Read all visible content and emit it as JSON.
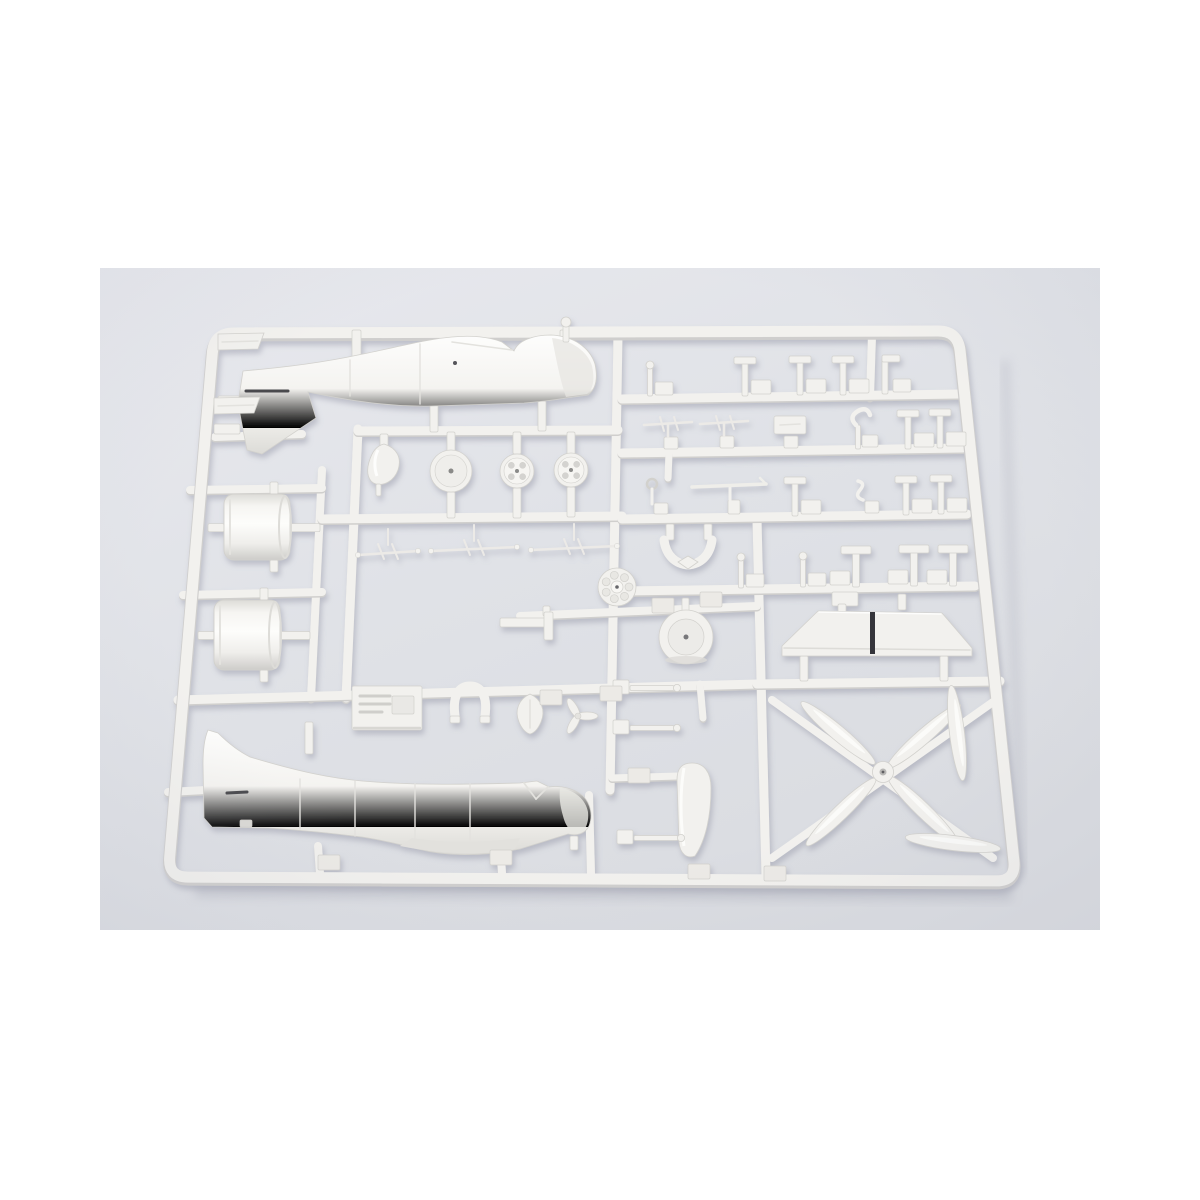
{
  "meta": {
    "description": "Product photograph of a white plastic injection-molded model kit sprue (parts tree) for an aircraft model, lying on a pale gray surface. The runner frame holds two fuselage halves, two engine cowlings, wheels, a spinner cone, a cowl ring, a wing center section, propeller blades and many small brackets and struts."
  },
  "canvas": {
    "width": 1200,
    "height": 1200,
    "page_bg": "#ffffff"
  },
  "photo": {
    "x": 100,
    "y": 268,
    "width": 1000,
    "height": 662,
    "bg_top": "#e8e9ee",
    "bg_mid": "#e0e2e7",
    "bg_bottom": "#dadce1",
    "vignette": "#b7bac6"
  },
  "colors": {
    "plastic": "#f2f1ee",
    "plastic_bright": "#fbfbf9",
    "plastic_shade": "#d7d6d3",
    "plastic_deep": "#c6c5c3",
    "edge": "#d2d1cd",
    "gate": "#eceae6",
    "detail_line": "#e3e2de",
    "slot_dark": "#35353a",
    "hole": "#8a8a88",
    "shadow": "#8d8fa0",
    "soft_shadow": "#b6b8c2"
  },
  "frame": {
    "corners": [
      [
        214,
        333
      ],
      [
        958,
        331
      ],
      [
        1016,
        881
      ],
      [
        168,
        877
      ]
    ],
    "radius": 20,
    "width": 11
  },
  "rails": [
    {
      "x1": 358,
      "y1": 429,
      "x2": 346,
      "y2": 698,
      "w": 9
    },
    {
      "x1": 322,
      "y1": 470,
      "x2": 311,
      "y2": 698,
      "w": 8
    },
    {
      "x1": 618,
      "y1": 335,
      "x2": 610,
      "y2": 790,
      "w": 9
    },
    {
      "x1": 757,
      "y1": 521,
      "x2": 766,
      "y2": 876,
      "w": 9
    },
    {
      "x1": 872,
      "y1": 335,
      "x2": 870,
      "y2": 397,
      "w": 8
    },
    {
      "x1": 358,
      "y1": 431,
      "x2": 618,
      "y2": 430,
      "w": 9
    },
    {
      "x1": 215,
      "y1": 437,
      "x2": 302,
      "y2": 434,
      "w": 8
    },
    {
      "x1": 322,
      "y1": 519,
      "x2": 622,
      "y2": 516,
      "w": 9
    },
    {
      "x1": 190,
      "y1": 490,
      "x2": 322,
      "y2": 488,
      "w": 8
    },
    {
      "x1": 183,
      "y1": 595,
      "x2": 322,
      "y2": 592,
      "w": 8
    },
    {
      "x1": 520,
      "y1": 616,
      "x2": 757,
      "y2": 606,
      "w": 8
    },
    {
      "x1": 178,
      "y1": 700,
      "x2": 757,
      "y2": 684,
      "w": 9
    },
    {
      "x1": 757,
      "y1": 684,
      "x2": 1000,
      "y2": 681,
      "w": 9
    },
    {
      "x1": 622,
      "y1": 399,
      "x2": 959,
      "y2": 394,
      "w": 9
    },
    {
      "x1": 622,
      "y1": 453,
      "x2": 963,
      "y2": 448,
      "w": 9
    },
    {
      "x1": 622,
      "y1": 519,
      "x2": 967,
      "y2": 514,
      "w": 9
    },
    {
      "x1": 622,
      "y1": 591,
      "x2": 975,
      "y2": 586,
      "w": 9
    },
    {
      "x1": 168,
      "y1": 792,
      "x2": 206,
      "y2": 790,
      "w": 8
    },
    {
      "x1": 589,
      "y1": 795,
      "x2": 591,
      "y2": 874,
      "w": 8
    },
    {
      "x1": 318,
      "y1": 846,
      "x2": 320,
      "y2": 874,
      "w": 8
    },
    {
      "x1": 500,
      "y1": 844,
      "x2": 502,
      "y2": 873,
      "w": 8
    },
    {
      "x1": 700,
      "y1": 684,
      "x2": 703,
      "y2": 718,
      "w": 7
    },
    {
      "x1": 669,
      "y1": 453,
      "x2": 668,
      "y2": 478,
      "w": 7
    },
    {
      "x1": 612,
      "y1": 778,
      "x2": 678,
      "y2": 776,
      "w": 7
    }
  ],
  "parts": [
    {
      "name": "fuselage-half-upper",
      "type": "fuselageTop"
    },
    {
      "name": "fuselage-half-lower",
      "type": "fuselageBottom"
    },
    {
      "name": "engine-cowling-a",
      "type": "cowling",
      "x": 224,
      "y": 494,
      "w": 66,
      "h": 66
    },
    {
      "name": "engine-cowling-b",
      "type": "cowling",
      "x": 214,
      "y": 600,
      "w": 66,
      "h": 70
    },
    {
      "name": "propeller-spinner-cone",
      "type": "cone",
      "x": 384,
      "y": 464
    },
    {
      "name": "wheel-hub-cover-disc",
      "type": "disc",
      "x": 451,
      "y": 471,
      "r": 21
    },
    {
      "name": "main-wheel-a",
      "type": "wheel",
      "x": 517,
      "y": 471,
      "r": 17
    },
    {
      "name": "main-wheel-b",
      "type": "wheel",
      "x": 571,
      "y": 470,
      "r": 17
    },
    {
      "name": "radial-engine-face",
      "type": "engine",
      "x": 617,
      "y": 587,
      "r": 19
    },
    {
      "name": "cowl-ring-drum",
      "type": "drum",
      "x": 686,
      "y": 637,
      "r": 27
    },
    {
      "name": "exhaust-u-bracket",
      "type": "ubracket",
      "x": 688,
      "y": 552
    },
    {
      "name": "wing-center-section",
      "type": "wing"
    },
    {
      "name": "propeller-blade-cluster",
      "type": "propeller",
      "hx": 883,
      "hy": 772
    },
    {
      "name": "rudder-blade",
      "type": "rudder"
    },
    {
      "name": "cockpit-floor-box",
      "type": "seatbox",
      "x": 352,
      "y": 686
    },
    {
      "name": "u-clamp",
      "type": "uclamp",
      "x": 470,
      "y": 703
    },
    {
      "name": "teardrop-fairing",
      "type": "teardrop",
      "x": 530,
      "y": 712
    },
    {
      "name": "small-prop-part",
      "type": "miniprop",
      "x": 578,
      "y": 716
    },
    {
      "name": "antenna-set",
      "type": "wirecluster",
      "x": 388,
      "y": 553,
      "l": 60
    },
    {
      "name": "pitot-rod",
      "type": "wirecluster",
      "x": 474,
      "y": 549,
      "l": 86
    },
    {
      "name": "gear-wire",
      "type": "wirecluster",
      "x": 574,
      "y": 548,
      "l": 86
    },
    {
      "name": "bracket-plate",
      "type": "flatbracket",
      "x": 500,
      "y": 618
    },
    {
      "name": "stabilizer-half-a",
      "type": "flatquad",
      "x": 218,
      "y": 333
    },
    {
      "name": "stabilizer-half-b",
      "type": "flatquad",
      "x": 214,
      "y": 397
    },
    {
      "name": "aerial-mast",
      "type": "mast",
      "x": 563,
      "y": 320
    }
  ],
  "small_parts": [
    {
      "t": "pin",
      "x": 650,
      "y": 396
    },
    {
      "t": "tb",
      "x": 745,
      "y": 396
    },
    {
      "t": "tb",
      "x": 800,
      "y": 395
    },
    {
      "t": "tb",
      "x": 843,
      "y": 395
    },
    {
      "t": "lb",
      "x": 885,
      "y": 394
    },
    {
      "t": "wire",
      "x": 668,
      "y": 451
    },
    {
      "t": "wire",
      "x": 724,
      "y": 450
    },
    {
      "t": "plate",
      "x": 790,
      "y": 450
    },
    {
      "t": "hook",
      "x": 858,
      "y": 449
    },
    {
      "t": "tb",
      "x": 908,
      "y": 449
    },
    {
      "t": "tb",
      "x": 940,
      "y": 448
    },
    {
      "t": "ringpin",
      "x": 652,
      "y": 516
    },
    {
      "t": "rod",
      "x": 732,
      "y": 516
    },
    {
      "t": "tb",
      "x": 795,
      "y": 516
    },
    {
      "t": "s",
      "x": 862,
      "y": 515
    },
    {
      "t": "tb",
      "x": 906,
      "y": 515
    },
    {
      "t": "tb",
      "x": 941,
      "y": 514
    },
    {
      "t": "pin",
      "x": 741,
      "y": 588
    },
    {
      "t": "pin",
      "x": 803,
      "y": 587
    },
    {
      "t": "tw",
      "x": 856,
      "y": 587
    },
    {
      "t": "tw",
      "x": 914,
      "y": 586
    },
    {
      "t": "tw",
      "x": 953,
      "y": 586
    },
    {
      "t": "hpin",
      "x": 630,
      "y": 688
    },
    {
      "t": "hpin",
      "x": 630,
      "y": 728
    },
    {
      "t": "hpin",
      "x": 634,
      "y": 838
    },
    {
      "t": "gate",
      "x": 318,
      "y": 855
    },
    {
      "t": "gate",
      "x": 490,
      "y": 850
    },
    {
      "t": "gate",
      "x": 688,
      "y": 864
    },
    {
      "t": "gate",
      "x": 764,
      "y": 866
    },
    {
      "t": "gate",
      "x": 628,
      "y": 768
    },
    {
      "t": "gate",
      "x": 652,
      "y": 598
    },
    {
      "t": "gate",
      "x": 700,
      "y": 592
    },
    {
      "t": "gate",
      "x": 540,
      "y": 690
    },
    {
      "t": "gate",
      "x": 600,
      "y": 686
    }
  ]
}
